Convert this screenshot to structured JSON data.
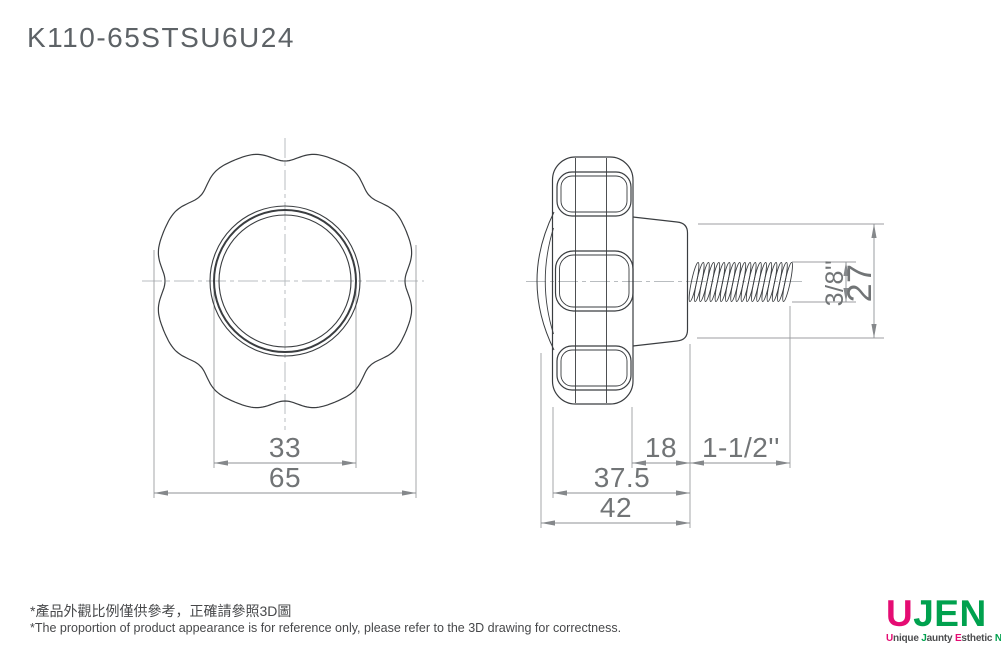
{
  "title": "K110-65STSU6U24",
  "views": {
    "front": {
      "dim_hub_diameter": "33",
      "dim_knob_diameter": "65"
    },
    "side": {
      "dim_hub_length": "18",
      "dim_thread_length": "1-1/2''",
      "dim_body_length": "37.5",
      "dim_total_length": "42",
      "dim_thread_diameter": "3/8''",
      "dim_boss_diameter": "27"
    }
  },
  "footnote": {
    "zh": "*產品外觀比例僅供參考，正確請參照3D圖",
    "en": "*The proportion of product appearance is for reference only, please refer to the 3D drawing for correctness."
  },
  "logo": {
    "brand": {
      "u": "U",
      "jen": "JEN"
    },
    "tagline": [
      {
        "head": "U",
        "rest": "nique"
      },
      {
        "head": "J",
        "rest": "aunty"
      },
      {
        "head": "E",
        "rest": "sthetic"
      },
      {
        "head": "N",
        "rest": "oble"
      }
    ],
    "colors": {
      "pink": "#e50c73",
      "green": "#00a14e"
    }
  }
}
